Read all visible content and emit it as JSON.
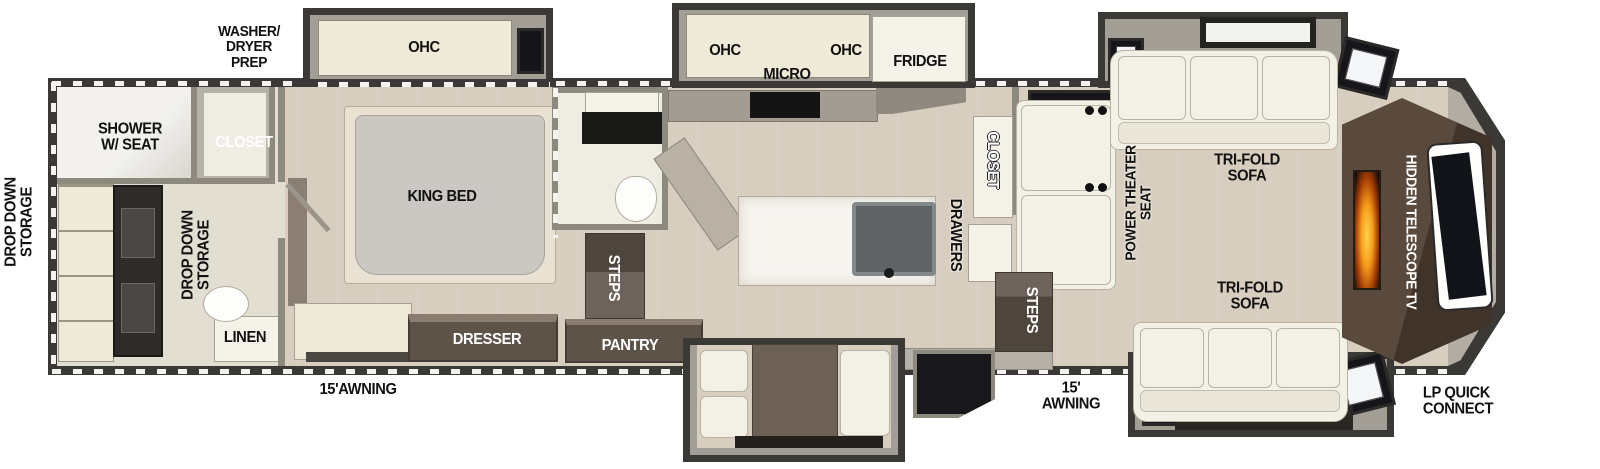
{
  "title": "RV fifth-wheel floor plan",
  "colors": {
    "wall": "#3b3936",
    "floor": "#d8cebf",
    "bath_floor": "#e3ded2",
    "cabinet_cream": "#efe9d8",
    "furniture_white": "#f5f2ea",
    "wood_brown": "#5d5349",
    "media_brown": "#4a3c32",
    "flame_orange": "#f59b1b",
    "slide_frame": "#a39e95"
  },
  "labels": {
    "washer_dryer_prep": "WASHER/\nDRYER\nPREP",
    "ohc_bedroom": "OHC",
    "shower_w_seat": "SHOWER\nW/ SEAT",
    "closet_front": "CLOSET",
    "drop_down_storage_left": "DROP DOWN\nSTORAGE",
    "drop_down_storage_bath": "DROP DOWN\nSTORAGE",
    "linen": "LINEN",
    "awning_left": "15'AWNING",
    "king_bed": "KING BED",
    "dresser": "DRESSER",
    "ohc_kitchen_left": "OHC",
    "micro": "MICRO",
    "ohc_kitchen_right": "OHC",
    "fridge": "FRIDGE",
    "closet_kitchen": "CLOSET",
    "drawers": "DRAWERS",
    "steps_mid": "STEPS",
    "pantry": "PANTRY",
    "steps_entry": "STEPS",
    "awning_right": "15'\nAWNING",
    "power_theater_seat": "POWER THEATER\nSEAT",
    "tri_fold_sofa_top": "TRI-FOLD\nSOFA",
    "tri_fold_sofa_bottom": "TRI-FOLD\nSOFA",
    "hidden_telescope_tv": "HIDDEN TELESCOPE TV",
    "lp_quick_connect": "LP QUICK\nCONNECT"
  }
}
